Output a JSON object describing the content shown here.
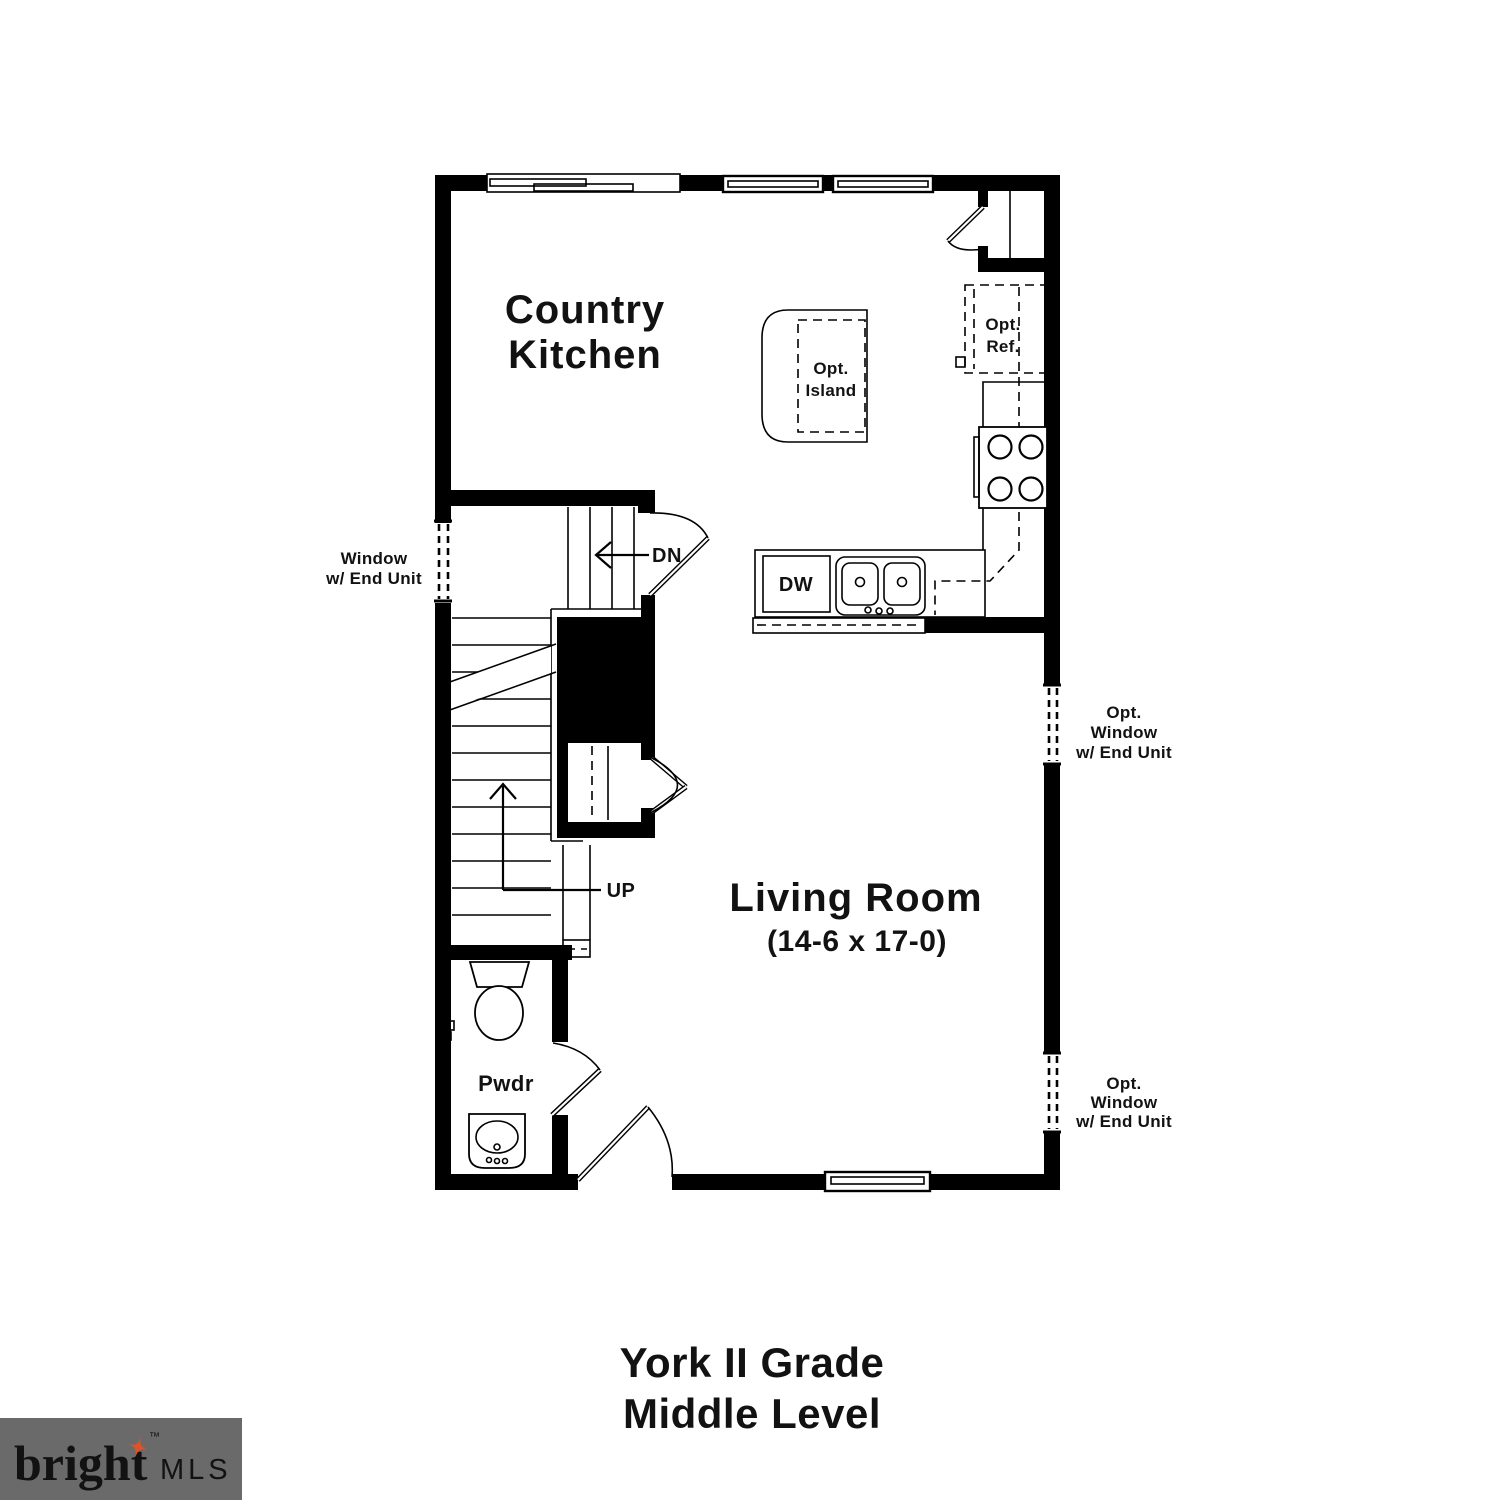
{
  "colors": {
    "background": "#ffffff",
    "walls": "#000000",
    "text": "#121212"
  },
  "plan": {
    "rooms": {
      "kitchen": {
        "line1": "Country",
        "line2": "Kitchen"
      },
      "living_room": {
        "name": "Living Room",
        "dimensions": "(14-6 x 17-0)"
      },
      "powder_room": {
        "name": "Pwdr"
      }
    },
    "fixtures": {
      "island": {
        "line1": "Opt.",
        "line2": "Island"
      },
      "refrigerator": {
        "line1": "Opt.",
        "line2": "Ref."
      },
      "dishwasher": {
        "label": "DW"
      }
    },
    "stairs": {
      "down_label": "DN",
      "up_label": "UP"
    },
    "window_notes": {
      "left": {
        "line1": "Window",
        "line2": "w/ End Unit"
      },
      "right_upper": {
        "line1": "Opt.",
        "line2": "Window",
        "line3": "w/ End Unit"
      },
      "right_lower": {
        "line1": "Opt.",
        "line2": "Window",
        "line3": "w/ End Unit"
      }
    }
  },
  "title": {
    "line1": "York II Grade",
    "line2": "Middle Level"
  },
  "logo": {
    "brand": "bright",
    "tm": "™",
    "suffix": "MLS",
    "bg_color": "#6a6a6a",
    "brand_color": "#f7f5f0",
    "suffix_color": "#cccccc",
    "star_color": "#dd5227"
  }
}
